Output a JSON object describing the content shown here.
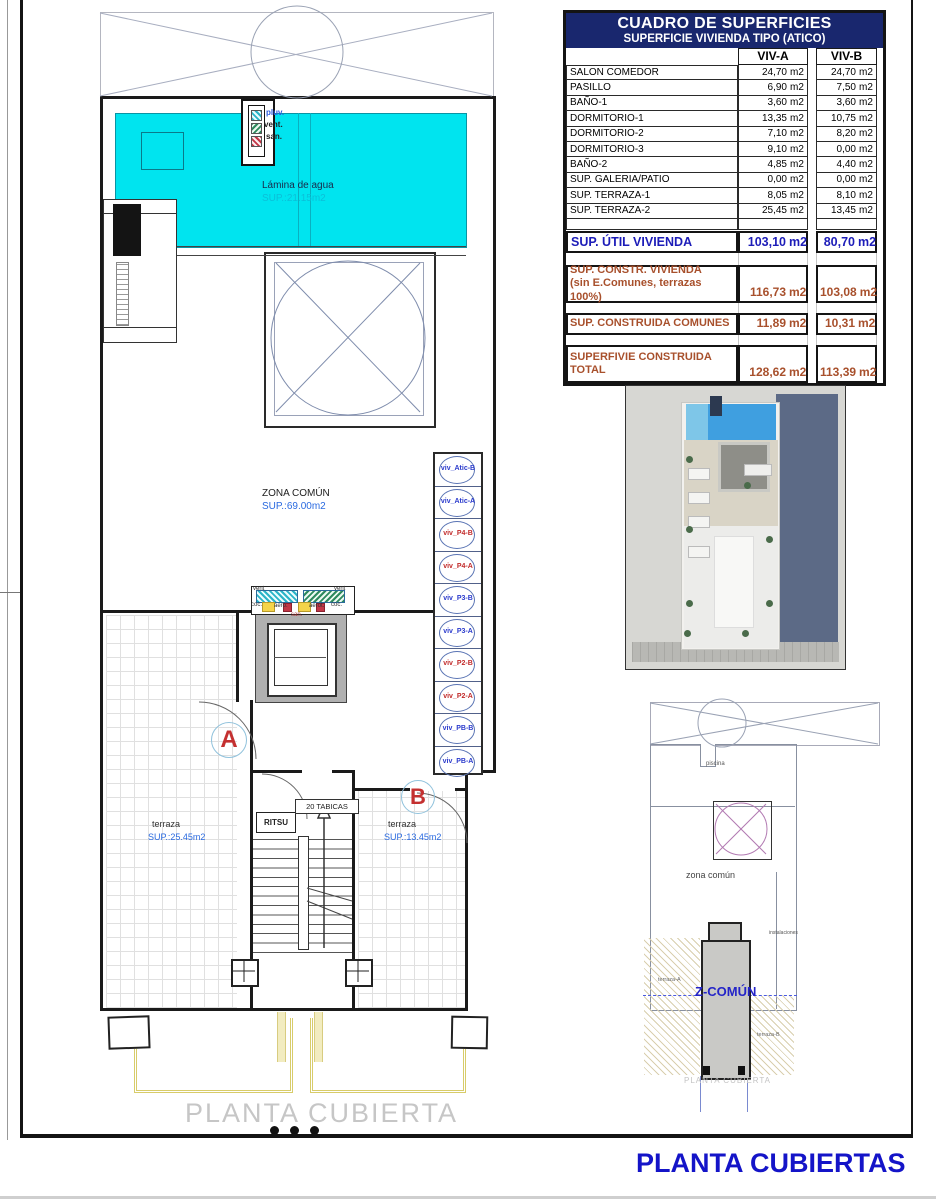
{
  "page": {
    "footer_title": "PLANTA CUBIERTAS"
  },
  "surface_table": {
    "title": "CUADRO DE SUPERFICIES",
    "subtitle": "SUPERFICIE VIVIENDA TIPO  (ATICO)",
    "columns": [
      "VIV-A",
      "VIV-B"
    ],
    "unit": "m2",
    "rows": [
      {
        "label": "SALON COMEDOR",
        "viv_a": "24,70",
        "viv_b": "24,70"
      },
      {
        "label": "PASILLO",
        "viv_a": "6,90",
        "viv_b": "7,50"
      },
      {
        "label": "BAÑO-1",
        "viv_a": "3,60",
        "viv_b": "3,60"
      },
      {
        "label": "DORMITORIO-1",
        "viv_a": "13,35",
        "viv_b": "10,75"
      },
      {
        "label": "DORMITORIO-2",
        "viv_a": "7,10",
        "viv_b": "8,20"
      },
      {
        "label": "DORMITORIO-3",
        "viv_a": "9,10",
        "viv_b": "0,00"
      },
      {
        "label": "BAÑO-2",
        "viv_a": "4,85",
        "viv_b": "4,40"
      },
      {
        "label": "SUP. GALERIA/PATIO",
        "viv_a": "0,00",
        "viv_b": "0,00"
      },
      {
        "label": "SUP. TERRAZA-1",
        "viv_a": "8,05",
        "viv_b": "8,10"
      },
      {
        "label": "SUP. TERRAZA-2",
        "viv_a": "25,45",
        "viv_b": "13,45"
      }
    ],
    "util": {
      "label": "SUP. ÚTIL VIVIENDA",
      "viv_a": "103,10",
      "viv_b": "80,70"
    },
    "constr": {
      "label_line1": "SUP. CONSTR. VIVIENDA",
      "label_line2": "(sin E.Comunes, terrazas 100%)",
      "viv_a": "116,73",
      "viv_b": "103,08"
    },
    "comunes": {
      "label": "SUP. CONSTRUIDA COMUNES",
      "viv_a": "11,89",
      "viv_b": "10,31"
    },
    "total": {
      "label_line1": "SUPERFIVIE CONSTRUIDA",
      "label_line2": "TOTAL",
      "viv_a": "128,62",
      "viv_b": "113,39"
    }
  },
  "floor_plan": {
    "pool": {
      "name": "Lámina de agua",
      "area": "SUP.:21.15m2"
    },
    "zona_comun": {
      "name": "ZONA COMÚN",
      "area": "SUP.:69.00m2"
    },
    "terraza_a": {
      "name": "terraza",
      "area": "SUP.:25.45m2"
    },
    "terraza_b": {
      "name": "terraza",
      "area": "SUP.:13.45m2"
    },
    "door_a": "A",
    "door_b": "B",
    "ritsu": "RITSU",
    "tabicas": "20 TABICAS",
    "riser_labels": {
      "pluv": "pluv.",
      "vent": "vent.",
      "san": "san."
    },
    "shaft_legend": {
      "vent": "vent",
      "coc": "coc.",
      "aero": "aero.",
      "aerot": "aerot.",
      "san": "san."
    },
    "caption": "PLANTA CUBIERTA",
    "viv_stack": [
      {
        "label": "viv_Atic-B",
        "color": "#2a3acc"
      },
      {
        "label": "viv_Atic-A",
        "color": "#2a3acc"
      },
      {
        "label": "viv_P4-B",
        "color": "#c22a2a"
      },
      {
        "label": "viv_P4-A",
        "color": "#c22a2a"
      },
      {
        "label": "viv_P3-B",
        "color": "#2a3acc"
      },
      {
        "label": "viv_P3-A",
        "color": "#2a3acc"
      },
      {
        "label": "viv_P2-B",
        "color": "#c22a2a"
      },
      {
        "label": "viv_P2-A",
        "color": "#c22a2a"
      },
      {
        "label": "viv_PB-B",
        "color": "#2a3acc"
      },
      {
        "label": "viv_PB-A",
        "color": "#2a3acc"
      }
    ]
  },
  "site_plan": {
    "piscina": "piscina",
    "zona_comun": "zona común",
    "instalaciones": "instalaciones",
    "terraza_a": "terraza-A",
    "terraza_b": "terraza-B",
    "core": "Z-COMÚN",
    "caption": "PLANTA CUBIERTA"
  },
  "colors": {
    "pool_cyan": "#00e4ef",
    "header_navy": "#19276e",
    "accent_blue": "#1c1cb8",
    "accent_brown": "#a8502c",
    "title_blue": "#1414c8",
    "viv_blue": "#2a3acc",
    "viv_red": "#c22a2a"
  }
}
